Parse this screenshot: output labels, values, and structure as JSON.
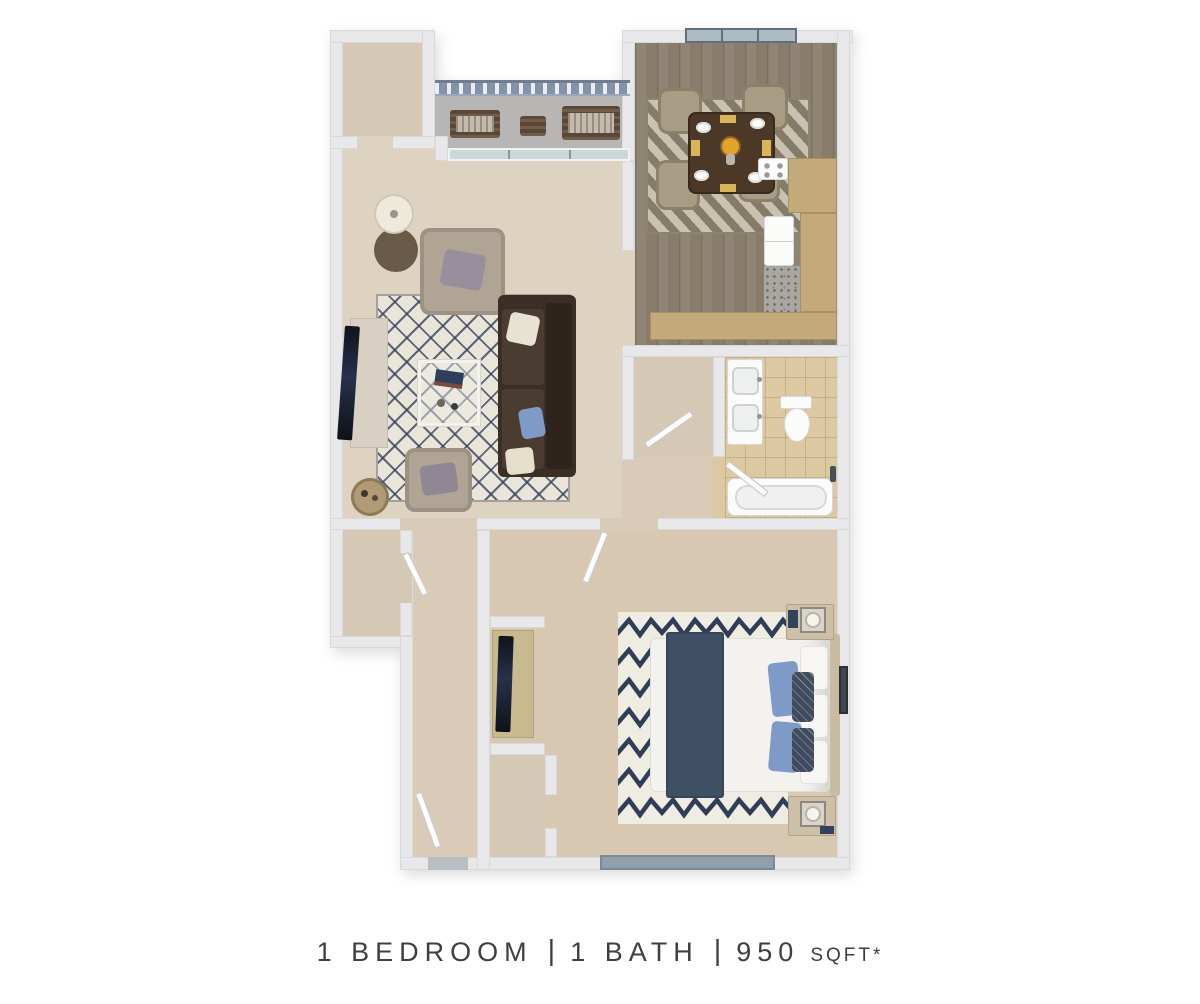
{
  "page": {
    "background_color": "#ffffff",
    "content_type": "apartment floor plan marketing render"
  },
  "caption": {
    "bedroom_label": "1 BEDROOM",
    "bath_label": "1 BATH",
    "area_value": "950",
    "area_unit": "SQFT*",
    "separator": "|",
    "text_color": "#3f3e43"
  },
  "summary": {
    "bedrooms": 1,
    "baths": 1,
    "sqft": 950
  },
  "floor_plan": {
    "view": "isometric 3d render, no room labels",
    "rooms": [
      {
        "name": "Balcony",
        "floor": "concrete",
        "furniture": [
          "outdoor-bench",
          "outdoor-bench",
          "outdoor-side-table",
          "railing"
        ]
      },
      {
        "name": "Storage Closet",
        "floor": "carpet",
        "furniture": []
      },
      {
        "name": "Living Room",
        "floor": "carpet",
        "furniture": [
          "sofa",
          "armchair",
          "armchair",
          "coffee-table",
          "tv-console",
          "tv",
          "side-table",
          "floor-lamp",
          "lattice-area-rug",
          "bar-cart",
          "sliding-glass-door"
        ]
      },
      {
        "name": "Dining Room",
        "floor": "hardwood",
        "furniture": [
          "dining-table",
          "dining-chair",
          "dining-chair",
          "dining-chair",
          "dining-chair",
          "striped-rug",
          "place-settings",
          "flower-centerpiece",
          "window"
        ]
      },
      {
        "name": "Kitchen",
        "floor": "granite-speckle",
        "furniture": [
          "refrigerator",
          "range",
          "l-shaped-counter",
          "peninsula-counter"
        ]
      },
      {
        "name": "Linen Closet",
        "floor": "carpet",
        "furniture": []
      },
      {
        "name": "Bathroom",
        "floor": "tile",
        "furniture": [
          "double-sink-vanity",
          "toilet",
          "bathtub",
          "towel-hook"
        ]
      },
      {
        "name": "Hallway",
        "floor": "carpet",
        "furniture": []
      },
      {
        "name": "Entry Hall",
        "floor": "carpet",
        "furniture": [
          "entry-door"
        ]
      },
      {
        "name": "Walk-in Closet",
        "floor": "carpet",
        "furniture": []
      },
      {
        "name": "Bedroom",
        "floor": "carpet",
        "furniture": [
          "queen-bed",
          "nightstand",
          "nightstand",
          "table-lamp",
          "table-lamp",
          "chevron-shag-rug",
          "tv-console",
          "tv",
          "wall-art",
          "window"
        ]
      },
      {
        "name": "Bedroom Closet",
        "floor": "carpet",
        "furniture": []
      }
    ],
    "palette": {
      "wall": "#e8e7e9",
      "wall_edge": "#d9d8db",
      "carpet_living": "#ded3c1",
      "carpet_bedroom": "#d8c8b2",
      "carpet_hall": "#d9cbb8",
      "closet_floor": "#d5c8b5",
      "balcony_concrete": "#b7b6b4",
      "railing_blue": "#8493a8",
      "wood_floor": "#897c6b",
      "dining_rug_base": "#b3a892",
      "kitchen_counter": "#c2aa7b",
      "kitchen_floor": "#a8a7a1",
      "bath_tile": "#dcc9a1",
      "fixture_white": "#fbfbfa",
      "sofa_brown": "#3a2e25",
      "sofa_cushion": "#4a3c31",
      "armchair_beige": "#b0a494",
      "dining_chair_beige": "#a99c84",
      "table_wood_dark": "#4b3827",
      "rug_cream": "#e9e5d8",
      "rug_navy": "#384362",
      "bedroom_rug_white": "#efece1",
      "chevron_navy": "#2f3d58",
      "bed_white": "#f3f2ef",
      "throw_navy": "#3e4f66",
      "pillow_blue": "#7e9ac7",
      "pillow_navy": "#3c4c68",
      "pillow_cream": "#e8e2d2",
      "nightstand_tan": "#cec0a8",
      "accent_yellow": "#d9b45a",
      "flower_yellow": "#e2a42c",
      "window_glass": "#aebbc4",
      "bedroom_window": "#8fa0ac",
      "threshold_gray": "#b9bec2",
      "tv_black": "#14171e",
      "console_cream": "#d8d1c3"
    }
  }
}
